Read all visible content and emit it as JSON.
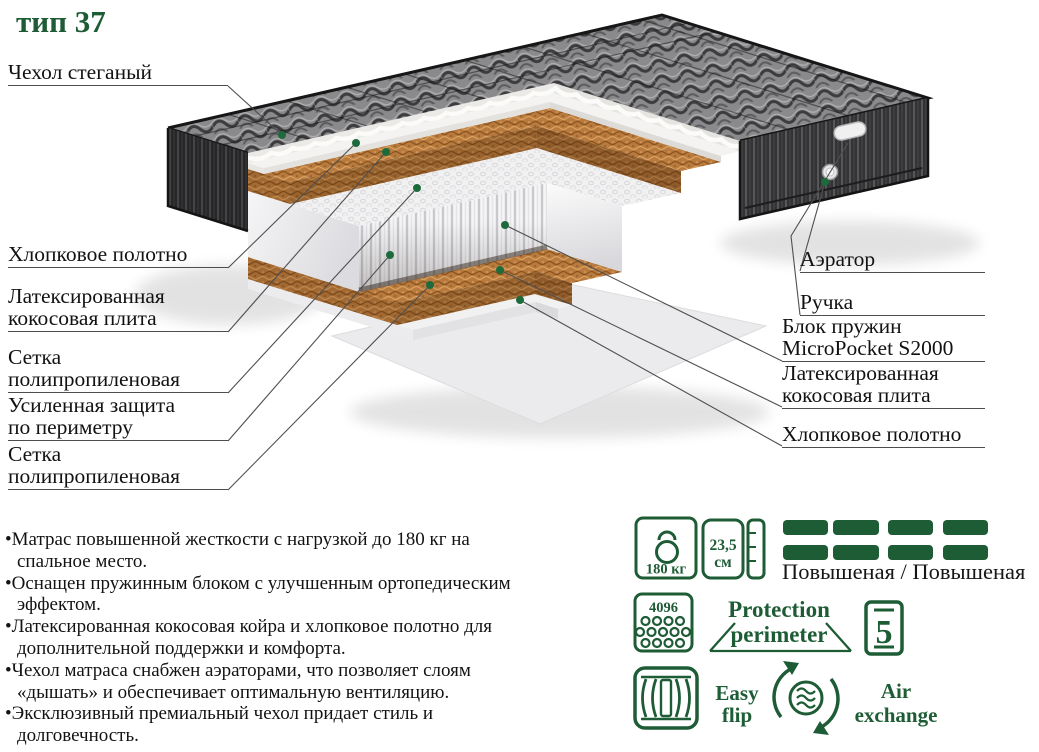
{
  "title": "тип 37",
  "callouts": {
    "left": [
      "Чехол стеганый",
      "Хлопковое полотно",
      "Латексированная\nкокосовая плита",
      "Сетка\nполипропиленовая",
      "Усиленная защита\nпо периметру",
      "Сетка\nполипропиленовая"
    ],
    "right": [
      "Аэратор",
      "Ручка",
      "Блок пружин\nMicroPocket S2000",
      "Латексированная\nкокосовая плита",
      "Хлопковое полотно"
    ]
  },
  "bullets": [
    "•Матрас повышенной жесткости с нагрузкой до 180 кг на\nспальное место.",
    "•Оснащен пружинным блоком с улучшенным ортопедическим\nэффектом.",
    "•Латексированная кокосовая койра и хлопковое полотно для\nдополнительной поддержки и комфорта.",
    "•Чехол матраса снабжен аэраторами, что позволяет слоям\n«дышать» и обеспечивает оптимальную вентиляцию.",
    "•Эксклюзивный премиальный чехол придает стиль и\nдолговечность."
  ],
  "specs": {
    "max_weight": "180 кг",
    "height_value": "23,5",
    "height_unit": "см",
    "springs_count": "4096",
    "firmness": "Повышеная / Повышеная",
    "protection_line1": "Protection",
    "protection_line2": "perimeter",
    "zones": "5",
    "easy_flip_line1": "Easy",
    "easy_flip_line2": "flip",
    "air_line1": "Air",
    "air_line2": "exchange"
  },
  "colors": {
    "accent_green": "#1e5c36"
  }
}
